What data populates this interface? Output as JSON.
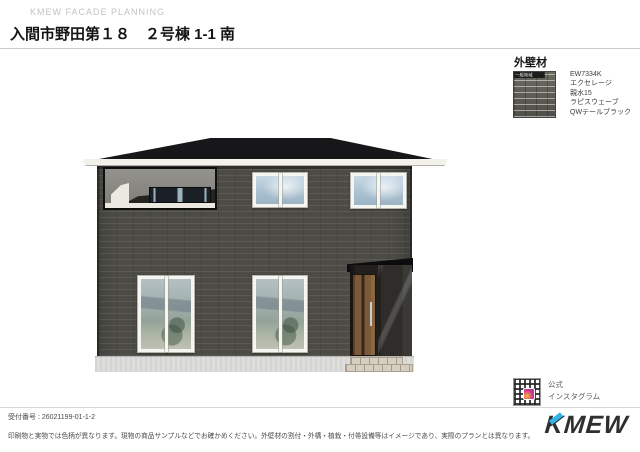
{
  "header": {
    "brand": "KMEW FACADE PLANNING",
    "title": "入間市野田第１８　２号棟 1-1 南"
  },
  "material_panel": {
    "heading": "外壁材",
    "swatch_label": "一般地域",
    "product_lines": [
      "EW7334K",
      "エクセレージ",
      "親水15",
      "ラピスウェーブ",
      "QWテールブラック"
    ]
  },
  "colors": {
    "wall": "#4c4b45",
    "roof": "#17171a",
    "fascia": "#f2f1ea",
    "foundation": "#dddddb",
    "door": "#7c5a38",
    "logo_accent": "#2fb3e8"
  },
  "footer": {
    "receipt_line": "受付番号 : 26021199-01-1-2",
    "disclaimer": "印刷物と実物では色柄が異なります。現物の商品サンプルなどでお確かめください。外壁材の割付・外構・植栽・付帯設備等はイメージであり、実際のプランとは異なります。",
    "qr_caption_line1": "公式",
    "qr_caption_line2": "インスタグラム",
    "logo_text": "KMEW"
  }
}
